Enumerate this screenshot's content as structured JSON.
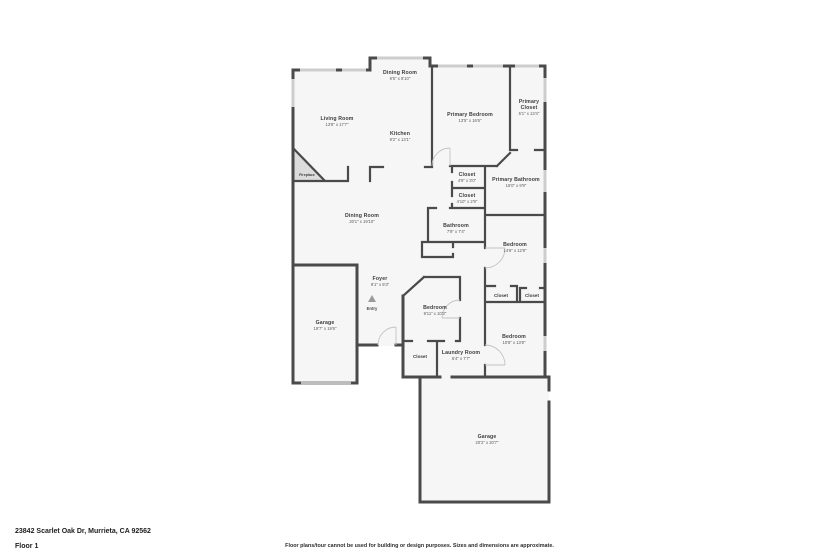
{
  "floorplan": {
    "rooms": {
      "dining_nook": {
        "name": "Dining Room",
        "dims": "9'5\" x 8'10\""
      },
      "living": {
        "name": "Living Room",
        "dims": "13'8\" x 17'7\""
      },
      "kitchen": {
        "name": "Kitchen",
        "dims": "9'2\" x 13'1\""
      },
      "primary_bedroom": {
        "name": "Primary Bedroom",
        "dims": "13'5\" x 16'6\""
      },
      "primary_closet": {
        "line1": "Primary",
        "line2": "Closet",
        "dims": "5'1\" x 13'4\""
      },
      "closet_top": {
        "name": "Closet",
        "dims": "4'9\" x 3'0\""
      },
      "primary_bathroom": {
        "name": "Primary Bathroom",
        "dims": "16'0\" x 9'9\""
      },
      "closet_mid": {
        "name": "Closet",
        "dims": "4'10\" x 2'9\""
      },
      "dining_main": {
        "name": "Dining Room",
        "dims": "20'1\" x 19'10\""
      },
      "bathroom": {
        "name": "Bathroom",
        "dims": "7'9\" x 7'4\""
      },
      "bedroom_right": {
        "name": "Bedroom",
        "dims": "14'6\" x 12'8\""
      },
      "foyer": {
        "name": "Foyer",
        "dims": "9'1\" x 5'3\""
      },
      "garage_left": {
        "name": "Garage",
        "dims": "19'7\" x 19'6\""
      },
      "bedroom_center": {
        "name": "Bedroom",
        "dims": "9'11\" x 10'3\""
      },
      "bedroom_bottom": {
        "name": "Bedroom",
        "dims": "10'8\" x 13'9\""
      },
      "laundry": {
        "name": "Laundry Room",
        "dims": "6'4\" x 7'7\""
      },
      "garage_bottom": {
        "name": "Garage",
        "dims": "20'2\" x 20'7\""
      },
      "closet_a": {
        "name": "Closet"
      },
      "closet_b": {
        "name": "Closet"
      },
      "closet_bottom": {
        "name": "Closet"
      },
      "fireplace": {
        "name": "Fireplace"
      }
    },
    "entry_label": "Entry",
    "wall_color": "#4a4a4a",
    "window_color": "#cdcdcd"
  },
  "footer": {
    "address": "23842 Scarlet Oak Dr, Murrieta, CA 92562",
    "floor_label": "Floor 1",
    "disclaimer": "Floor plans/tour cannot be used for building or design purposes. Sizes and dimensions are approximate."
  }
}
